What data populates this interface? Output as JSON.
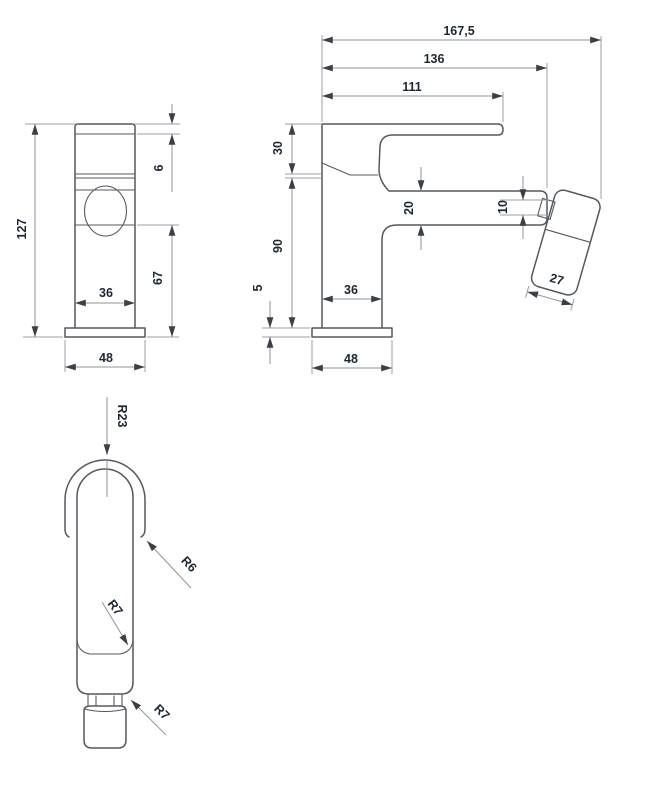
{
  "drawing": {
    "type": "technical-dimension-drawing",
    "subject": "bidet mixer tap with hand spray",
    "views": [
      "front-view",
      "side-view",
      "hand-spray-detail"
    ]
  },
  "dims": {
    "d167_5": "167,5",
    "d136": "136",
    "d111": "111",
    "d30": "30",
    "d90": "90",
    "d20": "20",
    "d10": "10",
    "d5": "5",
    "d36_side": "36",
    "d48_side": "48",
    "d27": "27",
    "d127": "127",
    "d6": "6",
    "d67": "67",
    "d36_front": "36",
    "d48_front": "48",
    "r23": "R23",
    "r6": "R6",
    "r7a": "R7",
    "r7b": "R7"
  },
  "colors": {
    "outline": "#54595f",
    "dimension_line": "#8f9499",
    "text": "#1c2734",
    "background": "#ffffff"
  }
}
